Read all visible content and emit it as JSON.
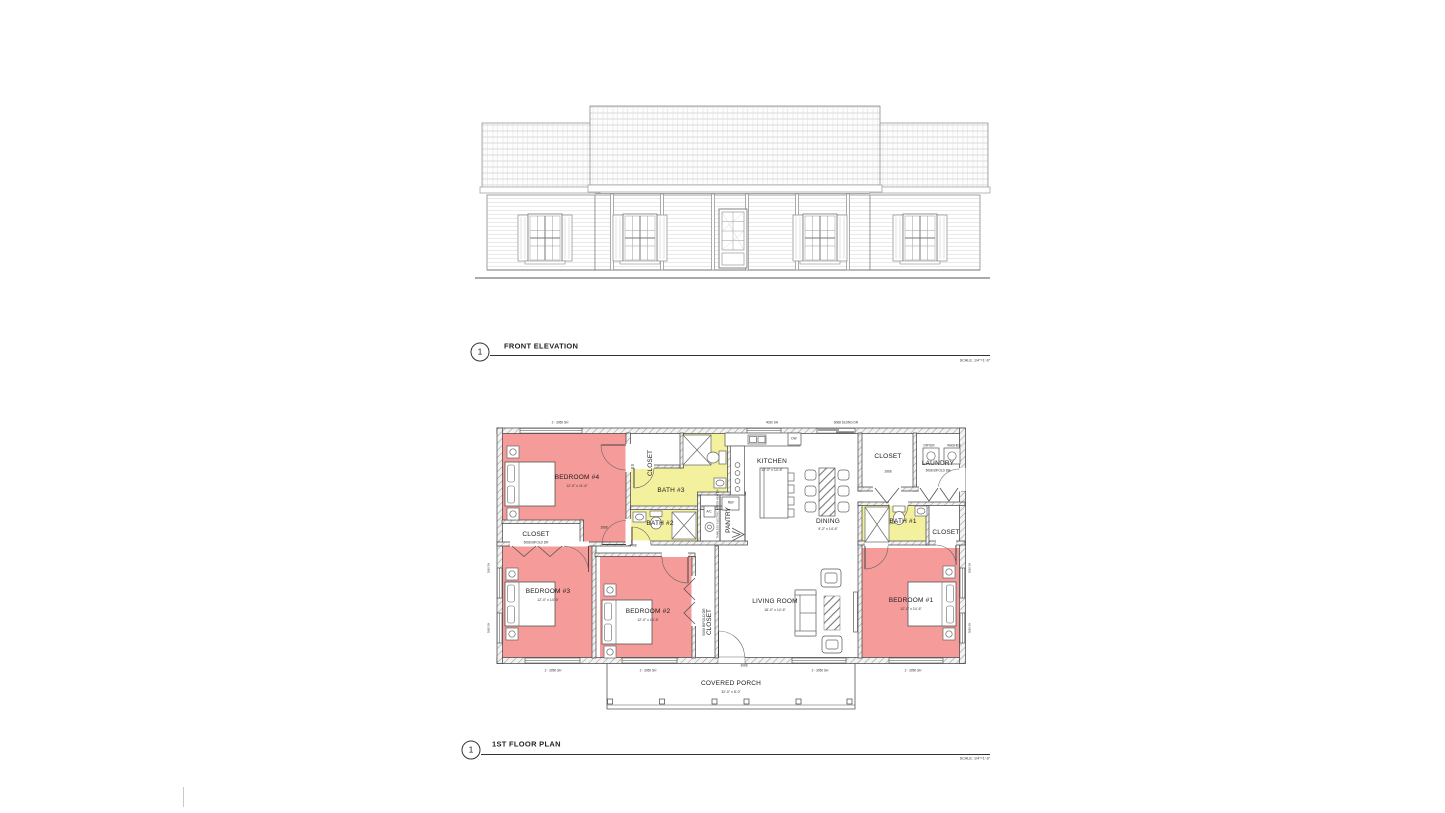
{
  "sheet": {
    "elevation": {
      "number": "1",
      "title": "FRONT ELEVATION",
      "scale": "SCALE: 1/4\"=1'-0\""
    },
    "plan": {
      "number": "1",
      "title": "1ST FLOOR PLAN",
      "scale": "SCALE: 1/4\"=1'-0\""
    }
  },
  "colors": {
    "bedroom_fill": "#f59b99",
    "bath_fill": "#f4f19e",
    "wall_line": "#3d3d3d"
  },
  "rooms": {
    "bedroom4": {
      "name": "BEDROOM #4",
      "dims": "12'-0\" x 11'-6\""
    },
    "bedroom3": {
      "name": "BEDROOM #3",
      "dims": "12'-0\" x 14'-6\""
    },
    "bedroom2": {
      "name": "BEDROOM #2",
      "dims": "12'-0\" x 14'-6\""
    },
    "bedroom1": {
      "name": "BEDROOM #1",
      "dims": "12'-0\" x 14'-6\""
    },
    "living": {
      "name": "LIVING ROOM",
      "dims": "18'-0\" x 14'-6\""
    },
    "kitchen": {
      "name": "KITCHEN",
      "dims": "12'-0\" x 14'-6\""
    },
    "dining": {
      "name": "DINING",
      "dims": "9'-2\" x 14'-6\""
    },
    "bath1": {
      "name": "BATH #1"
    },
    "bath2": {
      "name": "BATH #2"
    },
    "bath3": {
      "name": "BATH #3"
    },
    "laundry": {
      "name": "LAUNDRY",
      "door": "5068 BIFOLD DR",
      "dryer": "DRYER",
      "washer": "WASHER"
    },
    "pantry": {
      "name": "PANTRY"
    },
    "closet_hall": {
      "name": "CLOSET"
    },
    "closet_bed4": {
      "name": "CLOSET",
      "door": "5068 BIFOLD DR"
    },
    "closet_bed2": {
      "name": "CLOSET",
      "door": "5068 BIFOLD DR"
    },
    "closet_entry": {
      "name": "CLOSET"
    },
    "closet_bed1": {
      "name": "CLOSET"
    },
    "porch": {
      "name": "COVERED PORCH",
      "dims": "32'-0\" x 8'-0\""
    }
  },
  "fixtures": {
    "dishwasher": "DW",
    "ac_unit": "A/C",
    "fridge": "REF",
    "water_heater": "TANKLESS ELECTRIC WATER HEATER"
  },
  "openings": {
    "double_window": "2 - 3050 SH",
    "kitchen_window": "4030 SH",
    "sliding_door": "6068 SLDNG DR",
    "side_window": "3050 SH",
    "front_door": "3068",
    "closet_door": "2868",
    "bedroom_door": "2668",
    "bath_door": "2468"
  }
}
